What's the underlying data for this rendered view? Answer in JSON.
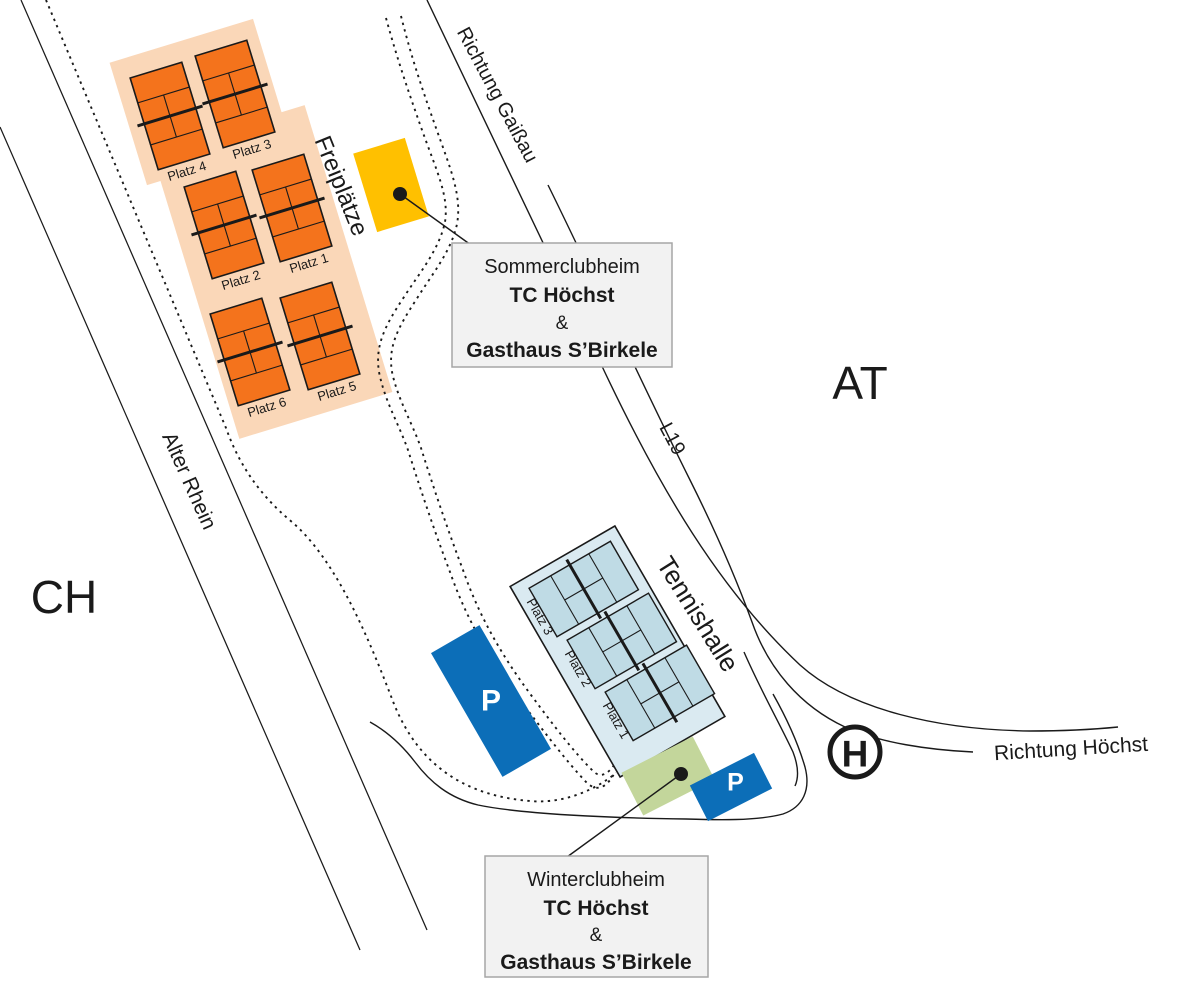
{
  "colors": {
    "ink": "#1A1A1A",
    "outdoor-court": "#F4731C",
    "outdoor-area": "#FAD7B8",
    "hall": "#DAEAF1",
    "indoor-court": "#BFDBE5",
    "parking": "#0C6EB8",
    "summer-building": "#FFC000",
    "winter-building": "#C3D69B",
    "callout-bg": "#F2F2F2",
    "callout-border": "#A6A6A6"
  },
  "map": {
    "regions": {
      "switzerland": "CH",
      "austria": "AT"
    },
    "roads": {
      "direction_gaissau": "Richtung Gaißau",
      "road_l19": "L19",
      "direction_hoechst": "Richtung Höchst",
      "river": "Alter Rhein"
    },
    "areas": {
      "outdoor_courts": "Freiplätze",
      "indoor_hall": "Tennishalle"
    },
    "outdoor_courts": [
      {
        "label": "Platz 4"
      },
      {
        "label": "Platz 3"
      },
      {
        "label": "Platz 2"
      },
      {
        "label": "Platz 1"
      },
      {
        "label": "Platz 6"
      },
      {
        "label": "Platz 5"
      }
    ],
    "indoor_courts": [
      {
        "label": "Platz 3"
      },
      {
        "label": "Platz 2"
      },
      {
        "label": "Platz 1"
      }
    ],
    "parking_label": "P",
    "bus_stop_label": "H",
    "callouts": {
      "summer": {
        "title": "Sommerclubheim",
        "club": "TC Höchst",
        "amp": "&",
        "restaurant": "Gasthaus S’Birkele"
      },
      "winter": {
        "title": "Winterclubheim",
        "club": "TC Höchst",
        "amp": "&",
        "restaurant": "Gasthaus S’Birkele"
      }
    }
  }
}
